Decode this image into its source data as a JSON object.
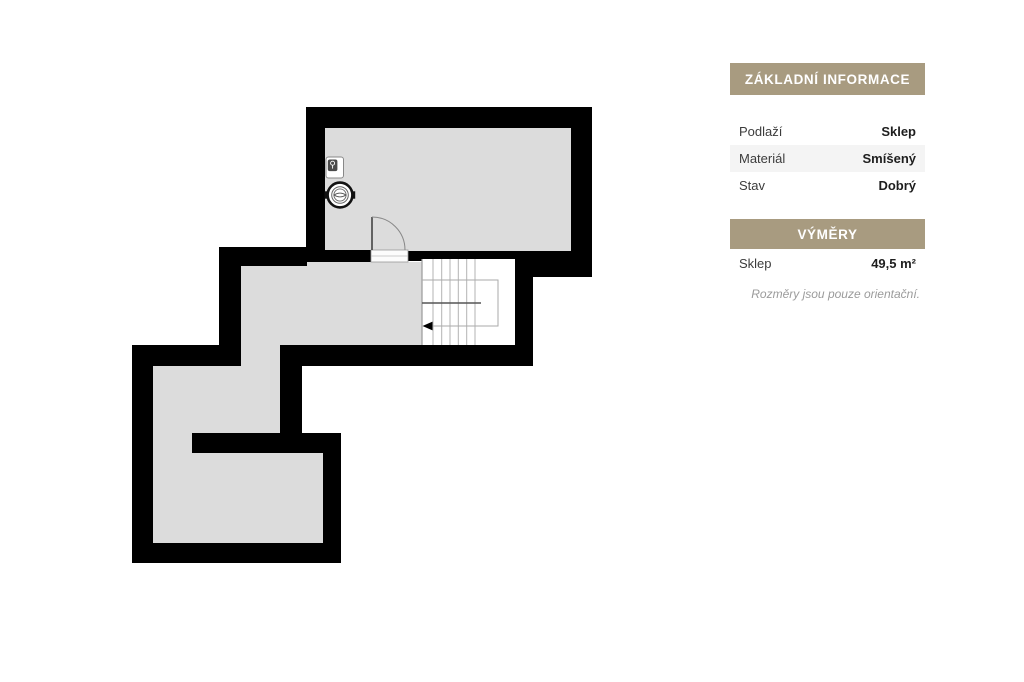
{
  "panel": {
    "sections": [
      {
        "title": "ZÁKLADNÍ INFORMACE",
        "rows": [
          {
            "label": "Podlaží",
            "value": "Sklep"
          },
          {
            "label": "Materiál",
            "value": "Smíšený"
          },
          {
            "label": "Stav",
            "value": "Dobrý"
          }
        ]
      },
      {
        "title": "VÝMĚRY",
        "rows": [
          {
            "label": "Sklep",
            "value": "49,5 m²"
          }
        ]
      }
    ],
    "note": "Rozměry jsou pouze orientační."
  },
  "floorplan": {
    "kind": "basement floor plan",
    "icons": [
      "washing-machine-icon",
      "boiler-icon",
      "stair-direction-arrow",
      "door-swing"
    ],
    "features": [
      "top-room",
      "corridor",
      "staircase",
      "lower-room"
    ]
  },
  "colors": {
    "accent": "#a89b80",
    "wall": "#000000",
    "floor": "#dcdcdc",
    "stripe": "#f4f4f4",
    "label": "#3c3c3c",
    "value": "#1e1e1e",
    "note": "#9b9b9b",
    "stairline": "#b3b3b3",
    "stairdivider": "#555555"
  }
}
